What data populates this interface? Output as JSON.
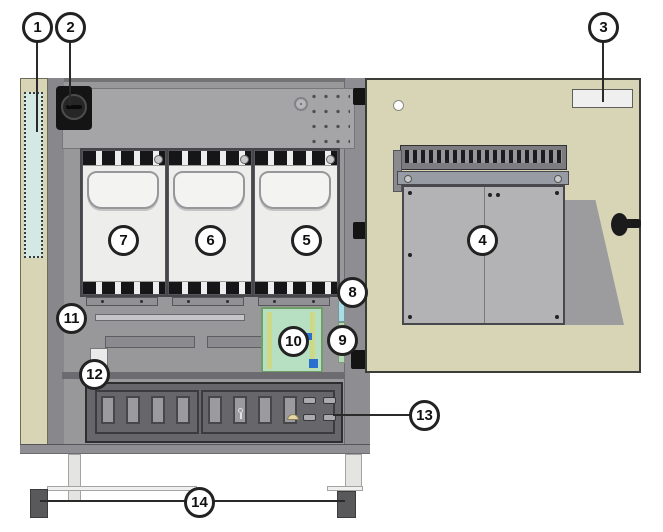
{
  "callouts": [
    "1",
    "2",
    "3",
    "4",
    "5",
    "6",
    "7",
    "8",
    "9",
    "10",
    "11",
    "12",
    "13",
    "14"
  ],
  "colors": {
    "cabinet_beige": "#d8d4b6",
    "interior_gray": "#98989a",
    "module_white": "#edeeec",
    "filter_teal": "#d4e8e4",
    "pcb_green": "#b7dfc2",
    "strip_cyan": "#a9dde6",
    "strip_green": "#b5d9b5",
    "panel_dark": "#67676b",
    "foot_gray": "#59595b",
    "callout_border": "#222222"
  },
  "icons": {
    "main_switch": "round-knob",
    "door_lock": "knob-with-bar",
    "hinge": "black-clip",
    "screw": "dot"
  }
}
